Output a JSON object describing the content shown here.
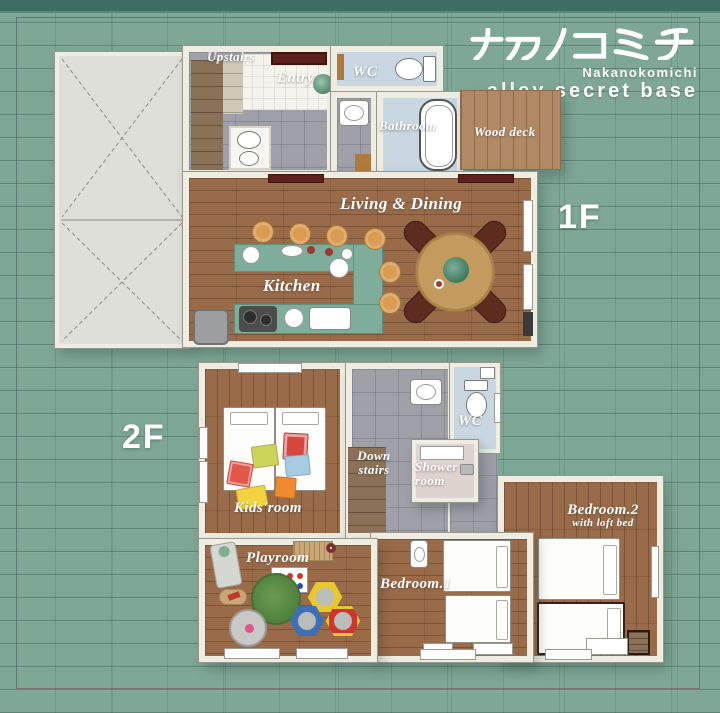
{
  "title": {
    "jp": "ナカノコミチ",
    "romaji": "Nakanokomichi",
    "subtitle": "alley secret base"
  },
  "floors": [
    {
      "floor_label": "1F",
      "rooms": {
        "upstairs": "Upstairs",
        "entry": "Entry",
        "wc": "WC",
        "bathroom": "Bathroom",
        "wood_deck": "Wood deck",
        "living_dining": "Living & Dining",
        "kitchen": "Kitchen"
      }
    },
    {
      "floor_label": "2F",
      "rooms": {
        "kids_room": "Kids'room",
        "down_stairs": "Down stairs",
        "wc": "WC",
        "shower_room": "Shower room",
        "playroom": "Playroom",
        "bedroom1": "Bedroom.1",
        "bedroom2": "Bedroom.2",
        "bedroom2_note": "with loft bed"
      }
    }
  ],
  "colors": {
    "background_green": "#7FA796",
    "background_band": "#3C6F62",
    "wall_cream": "#EFECE1",
    "wood_floor": "#9A6B49",
    "wood_deck": "#B18965",
    "kitchen_counter": "#7FAD9B",
    "bath_blue": "#C8D7E1",
    "tile_gray": "#A0A0A8",
    "stair_brown": "#8B7158",
    "accent_dark_red": "#5E2119",
    "rug_green": "#5E8F46",
    "text_white": "#FFFFFF"
  }
}
